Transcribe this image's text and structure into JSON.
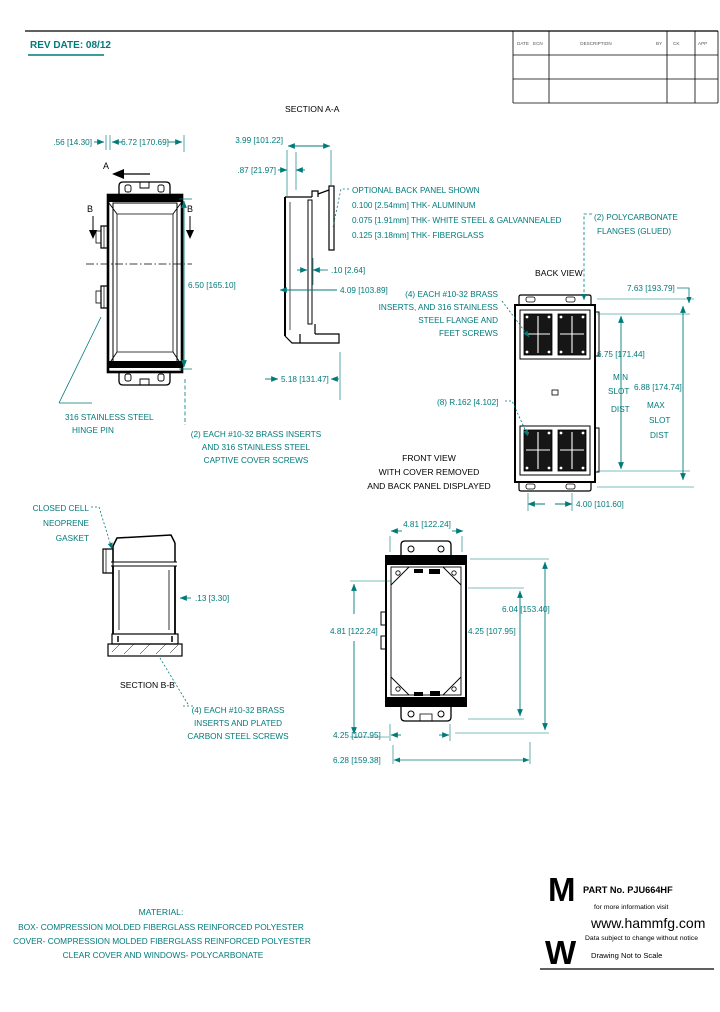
{
  "colors": {
    "annotation": "#007a7a",
    "geometry": "#000000",
    "background": "#ffffff"
  },
  "header": {
    "rev_date": "REV DATE: 08/12",
    "table": {
      "date": "DATE",
      "ecn": "ECN",
      "description": "DESCRIPTION",
      "by": "BY",
      "ck": "CK",
      "app": "APP"
    }
  },
  "view_titles": {
    "section_aa": "SECTION A-A",
    "back_view": "BACK VIEW",
    "front_view": [
      "FRONT VIEW",
      "WITH COVER REMOVED",
      "AND BACK PANEL DISPLAYED"
    ],
    "section_bb": "SECTION B-B"
  },
  "markers": {
    "a": "A",
    "b": "B"
  },
  "dims": {
    "w_small": ".56 [14.30]",
    "w_cover": "6.72 [170.69]",
    "h_cover": "6.50 [165.10]",
    "depth_total": "3.99 [101.22]",
    "depth_cover": ".87 [21.97]",
    "panel_thk": ".10 [2.64]",
    "depth_inner": "4.09 [103.89]",
    "depth_outer": "5.18 [131.47]",
    "back_len": "7.63 [193.79]",
    "slot_min": "6.75 [171.44]",
    "slot_min_2": "MIN",
    "slot_min_3": "SLOT",
    "slot_min_4": "DIST",
    "slot_max": "6.88 [174.74]",
    "slot_max_2": "MAX",
    "slot_max_3": "SLOT",
    "slot_max_4": "DIST",
    "corner_radius": "(8) R.162 [4.102]",
    "slot_width": "4.00 [101.60]",
    "front_w_top": "4.81 [122.24]",
    "front_w_left": "4.81 [122.24]",
    "front_w_right": "4.25 [107.95]",
    "front_h": "6.04 [153.40]",
    "front_w_bot": "4.25 [107.95]",
    "front_w_overall": "6.28 [159.38]",
    "wall_thk": ".13 [3.30]"
  },
  "notes": {
    "hinge": [
      "316 STAINLESS STEEL",
      "HINGE PIN"
    ],
    "captive_screws": [
      "(2) EACH #10-32 BRASS INSERTS",
      "AND 316 STAINLESS STEEL",
      "CAPTIVE COVER SCREWS"
    ],
    "back_panel": [
      "OPTIONAL BACK PANEL SHOWN",
      "0.100 [2.54mm] THK- ALUMINUM",
      "0.075 [1.91mm] THK- WHITE STEEL & GALVANNEALED",
      "0.125 [3.18mm] THK- FIBERGLASS"
    ],
    "flanges": [
      "(2) POLYCARBONATE",
      "FLANGES (GLUED)"
    ],
    "feet_screws": [
      "(4) EACH #10-32 BRASS",
      "INSERTS, AND 316 STAINLESS",
      "STEEL FLANGE AND",
      "FEET SCREWS"
    ],
    "gasket": [
      "CLOSED CELL",
      "NEOPRENE",
      "GASKET"
    ],
    "carbon_screws": [
      "(4) EACH #10-32 BRASS",
      "INSERTS AND PLATED",
      "CARBON STEEL SCREWS"
    ]
  },
  "material": {
    "title": "MATERIAL:",
    "lines": [
      "BOX- COMPRESSION MOLDED FIBERGLASS REINFORCED POLYESTER",
      "COVER- COMPRESSION MOLDED FIBERGLASS REINFORCED POLYESTER",
      "CLEAR COVER AND WINDOWS- POLYCARBONATE"
    ]
  },
  "footer": {
    "part_label": "PART No. PJU664HF",
    "info": "for more information visit",
    "url": "www.hammfg.com",
    "disclaimer": "Data subject to change without notice",
    "scale_note": "Drawing Not to Scale",
    "logo_top": "M",
    "logo_bottom": "W"
  }
}
